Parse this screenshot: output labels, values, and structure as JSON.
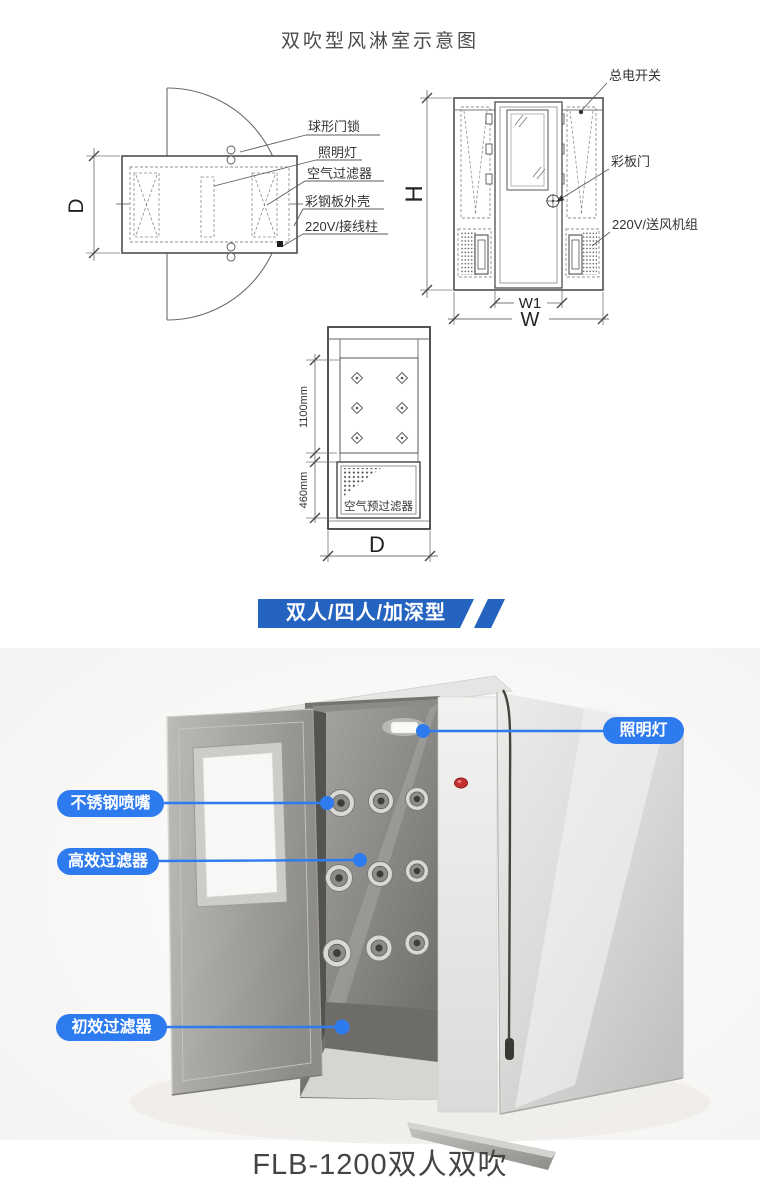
{
  "title": "双吹型风淋室示意图",
  "plan_view": {
    "callouts": {
      "door_lock": "球形门锁",
      "light": "照明灯",
      "air_filter": "空气过滤器",
      "shell": "彩钢板外壳",
      "terminal": "220V/接线柱"
    },
    "dim_depth": "D"
  },
  "front_view": {
    "callouts": {
      "main_switch": "总电开关",
      "panel_door": "彩板门",
      "blower": "220V/送风机组"
    },
    "dim_height": "H",
    "dim_door_width": "W1",
    "dim_width": "W"
  },
  "side_view": {
    "dim_upper": "1100mm",
    "dim_lower": "460mm",
    "dim_depth": "D",
    "prefilter": "空气预过滤器"
  },
  "banner": {
    "label": "双人/四人/加深型",
    "color": "#2563c0"
  },
  "photo": {
    "callout_light": "照明灯",
    "callout_nozzle": "不锈钢喷嘴",
    "callout_hepa": "高效过滤器",
    "callout_prefilter": "初效过滤器",
    "caption": "FLB-1200双人双吹",
    "accent_color": "#2e7bef"
  }
}
